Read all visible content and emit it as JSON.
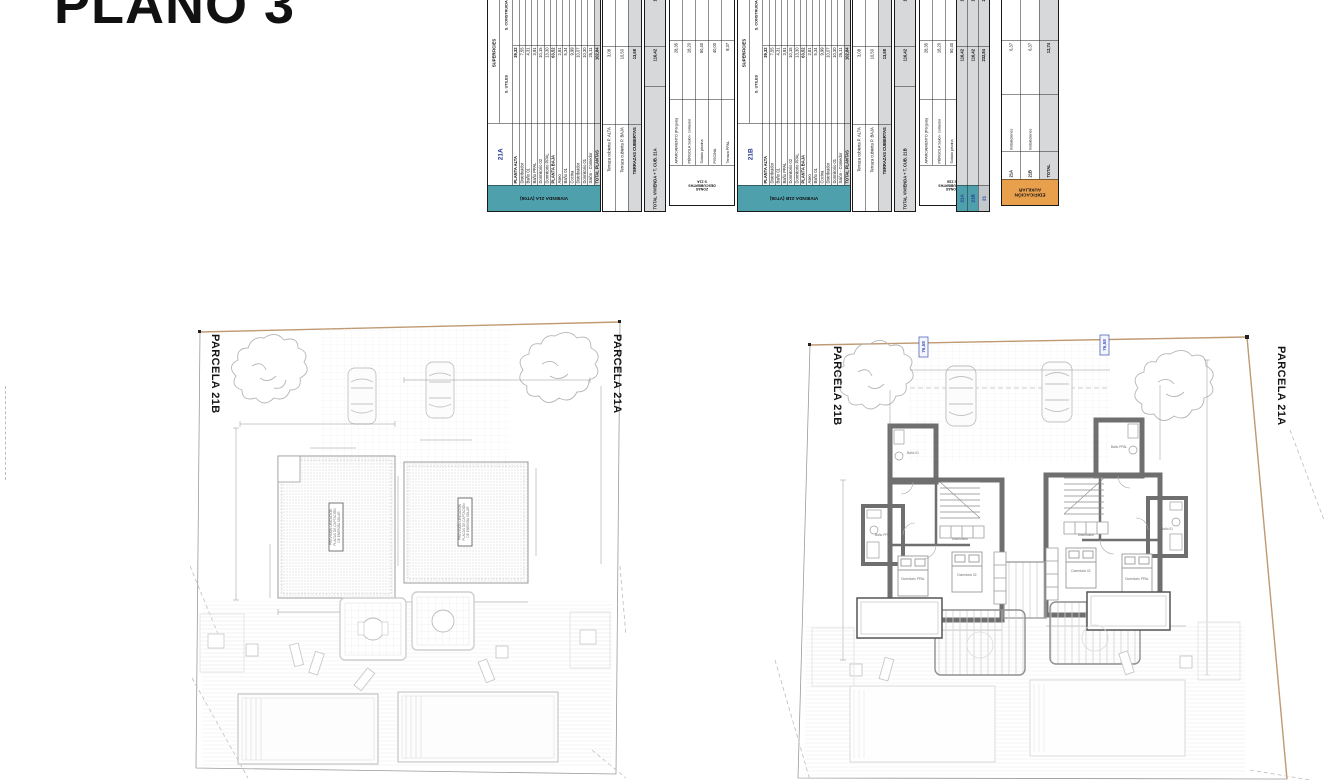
{
  "title": "PLANO 3",
  "colors": {
    "teal": "#4fa0ad",
    "orange": "#e8a04c",
    "navy": "#20368f",
    "total_gray": "#d6d8da",
    "boundary_tan": "#c09a72"
  },
  "tables": {
    "header": {
      "superficies": "SUPERFICIES",
      "utiles": "S. UTILES",
      "construidas": "S. CONSTRUIDAS"
    },
    "viv21a": {
      "id_label": "21A",
      "side_label": "VIVIENDA 21A (VT06)",
      "rows": [
        {
          "label": "PLANTA ALTA",
          "utiles": "39,32",
          "constr": "4",
          "bold": true
        },
        {
          "label": "Distribuidor",
          "utiles": "7,55"
        },
        {
          "label": "Baño 01",
          "utiles": "4,31"
        },
        {
          "label": "Baño PPAL",
          "utiles": "3,91"
        },
        {
          "label": "Dormitorio 02",
          "utiles": "10,15"
        },
        {
          "label": "Dormitorio PPAL",
          "utiles": "13,30"
        },
        {
          "label": "PLANTA BAJA",
          "utiles": "63,52",
          "constr": "7",
          "bold": true
        },
        {
          "label": "Aseo",
          "utiles": "2,81"
        },
        {
          "label": "Baño 01",
          "utiles": "5,34"
        },
        {
          "label": "Cocina",
          "utiles": "9,99"
        },
        {
          "label": "Distribuidor",
          "utiles": "10,07"
        },
        {
          "label": "Dormitorio 01",
          "utiles": "10,30"
        },
        {
          "label": "Salón - Comedor",
          "utiles": "25,11"
        },
        {
          "label": "TOTAL PLANTAS",
          "utiles": "102,84",
          "constr": "12",
          "bold": true,
          "fill": "gray"
        }
      ],
      "terraza_rows": [
        {
          "label": "Terraza cubierta P. ALTA",
          "utiles": "3,08"
        },
        {
          "label": "Terraza cubierta P. BAJA",
          "utiles": "10,50"
        },
        {
          "label": "TERRAZAS CUBIERTAS",
          "utiles": "13,58",
          "constr": "1",
          "bold": true,
          "fill": "gray"
        }
      ],
      "total_row": {
        "label": "TOTAL VIVIENDA + T. CUB. 21A",
        "utiles": "116,42",
        "constr": "13",
        "bold": true,
        "fill": "gray"
      }
    },
    "zonas21a": {
      "side_lines": [
        "ZONAS",
        "DESCUBIERTAS",
        "S 21A"
      ],
      "rows": [
        {
          "label": "APARCAMIENTO (Pérgola)",
          "value": "28,35"
        },
        {
          "label": "PÉRGOLA Salón- comedor",
          "value": "18,20"
        },
        {
          "label": "Solado piscina",
          "value": "50,40"
        },
        {
          "label": "PISCINA",
          "value": "40,00"
        },
        {
          "label": "Terraza PPAL",
          "value": "9,37"
        }
      ]
    },
    "viv21b": {
      "id_label": "21B",
      "side_label": "VIVIENDA 21B (VT06)",
      "rows": [
        {
          "label": "PLANTA ALTA",
          "utiles": "39,32",
          "constr": "4",
          "bold": true
        },
        {
          "label": "Distribuidor",
          "utiles": "7,55"
        },
        {
          "label": "Baño 01",
          "utiles": "4,31"
        },
        {
          "label": "Baño PPAL",
          "utiles": "3,91"
        },
        {
          "label": "Dormitorio 02",
          "utiles": "10,15"
        },
        {
          "label": "Dormitorio PPAL",
          "utiles": "13,30"
        },
        {
          "label": "PLANTA BAJA",
          "utiles": "63,52",
          "constr": "7",
          "bold": true
        },
        {
          "label": "Aseo",
          "utiles": "2,81"
        },
        {
          "label": "Baño 01",
          "utiles": "5,34"
        },
        {
          "label": "Cocina",
          "utiles": "9,99"
        },
        {
          "label": "Distribuidor",
          "utiles": "10,07"
        },
        {
          "label": "Dormitorio 01",
          "utiles": "10,30"
        },
        {
          "label": "Salón - Comedor",
          "utiles": "25,11"
        },
        {
          "label": "TOTAL PLANTAS",
          "utiles": "102,84",
          "constr": "12",
          "bold": true,
          "fill": "gray"
        }
      ],
      "terraza_rows": [
        {
          "label": "Terraza cubierta P. ALTA",
          "utiles": "3,08"
        },
        {
          "label": "Terraza cubierta P. BAJA",
          "utiles": "10,50"
        },
        {
          "label": "TERRAZAS CUBIERTAS",
          "utiles": "13,58",
          "constr": "1",
          "bold": true,
          "fill": "gray"
        }
      ],
      "total_row": {
        "label": "TOTAL VIVIENDA + T. CUB. 21B",
        "utiles": "116,42",
        "constr": "13",
        "bold": true,
        "fill": "gray"
      }
    },
    "zonas21b": {
      "side_lines": [
        "ZONAS",
        "DESCUBIERTAS",
        "S 21B"
      ],
      "rows": [
        {
          "label": "APARCAMIENTO (Pérgola)",
          "value": "28,35"
        },
        {
          "label": "PÉRGOLA Salón- comedor",
          "value": "18,20"
        },
        {
          "label": "Solado piscina",
          "value": "50,40"
        },
        {
          "label": "PISCINA",
          "value": "40,00"
        },
        {
          "label": "Terraza PPAL",
          "value": "9,37"
        }
      ]
    },
    "resumen": {
      "rows": [
        {
          "label": "21A",
          "value": "116,42",
          "constr": "13",
          "cell": "teal"
        },
        {
          "label": "21B",
          "value": "116,42",
          "constr": "13",
          "cell": "teal"
        },
        {
          "label": "21",
          "value": "232,84",
          "constr": "27",
          "cell": "gray"
        }
      ]
    },
    "auxiliar": {
      "side_lines": [
        "EDIFICACIÓN",
        "AUXILIAR"
      ],
      "rows": [
        {
          "label": "21A",
          "name": "Instalaciones",
          "value": "6,37"
        },
        {
          "label": "21B",
          "name": "Instalaciones",
          "value": "6,37"
        },
        {
          "label": "TOTAL",
          "name": "",
          "value": "12,74",
          "constr": "1",
          "bold": true,
          "fill": "gray"
        }
      ]
    }
  },
  "plans": {
    "left": {
      "label_left": "PARCELA 21B",
      "label_right": "PARCELA 21A",
      "solar_note_lines": [
        "PREVISIÓN UBICACIÓN",
        "PLACAS DE CAPTACIÓN",
        "DE ENERGÍA SOLAR"
      ]
    },
    "right": {
      "label_left": "PARCELA 21B",
      "label_right": "PARCELA 21A",
      "level_left": "76,58",
      "level_right": "76,58",
      "room_labels": [
        "Dormitorio PPAL",
        "Dormitorio 02",
        "Baño PPAL",
        "Baño 01",
        "Distribuidor"
      ]
    }
  }
}
